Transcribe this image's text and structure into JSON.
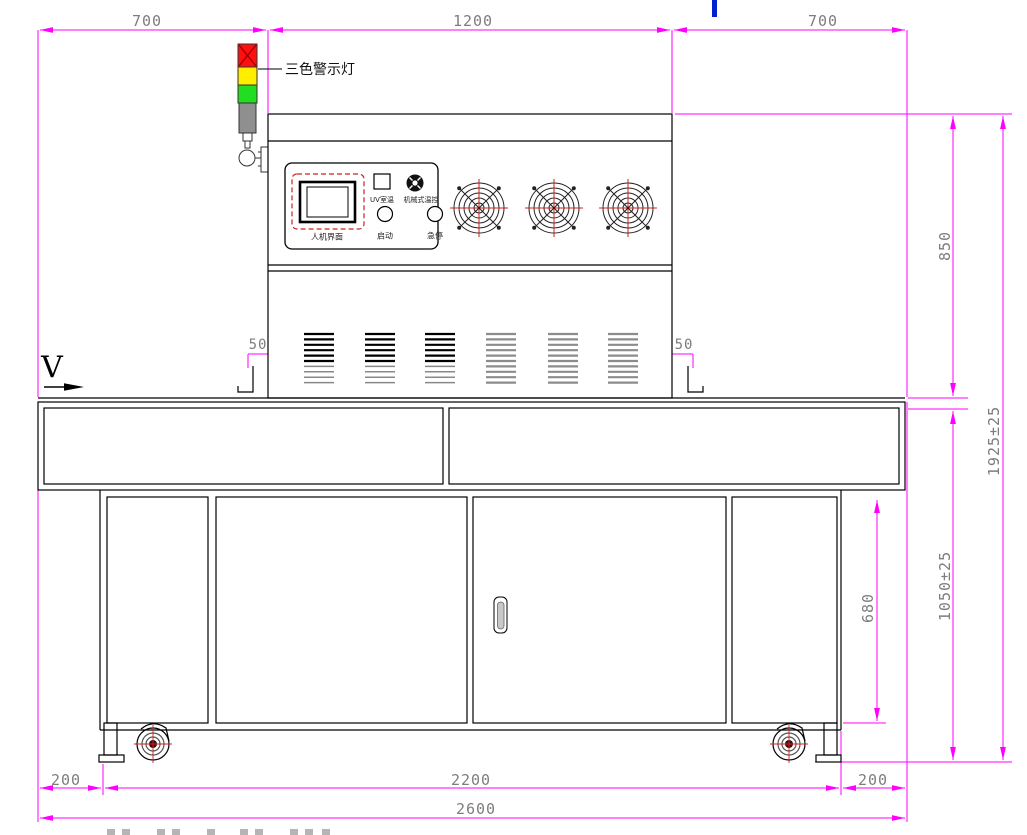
{
  "drawing_title": "UV machine front elevation drawing",
  "colors": {
    "dimension_line": "#ff00ff",
    "dimension_text": "#7d7d7d",
    "outline": "#000000",
    "accent_red": "#cc2222",
    "warning_red": "#ff1010",
    "warning_yellow": "#ffee00",
    "warning_green": "#22dd22",
    "pole_gray": "#8f8f8f",
    "blue_mark": "#0022cc"
  },
  "annotations": {
    "warning_light_label": "三色警示灯",
    "view_marker": "V"
  },
  "control_panel": {
    "hmi": "人机界面",
    "uv_window": "UV室温",
    "thermostat": "机械式温控",
    "start": "启动",
    "estop": "急停"
  },
  "dimensions": {
    "top_left": "700",
    "top_center": "1200",
    "top_right": "700",
    "right_upper": "850",
    "right_total": "1925±25",
    "right_lower": "1050±25",
    "door_height": "680",
    "flange_left": "50",
    "flange_right": "50",
    "bottom_left": "200",
    "bottom_center": "2200",
    "bottom_right": "200",
    "bottom_total": "2600"
  }
}
